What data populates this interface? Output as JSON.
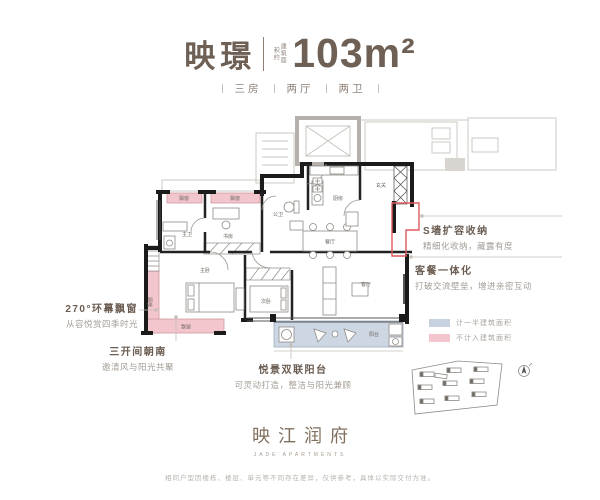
{
  "header": {
    "name": "映璟",
    "area_note": "建筑面积约",
    "area": "103m²",
    "specs": [
      "三房",
      "两厅",
      "两卫"
    ]
  },
  "annotations": {
    "s_wall": {
      "title": "S墙扩容收纳",
      "desc": "精细化收纳，藏露有度"
    },
    "dining_living": {
      "title": "客餐一体化",
      "desc": "打破交流壁垒，增进亲密互动"
    },
    "bay_window": {
      "title": "270°环幕飘窗",
      "desc": "从容悦赏四季时光"
    },
    "south_rooms": {
      "title": "三开间朝南",
      "desc": "邀清风与阳光共聚"
    },
    "balcony": {
      "title": "悦景双联阳台",
      "desc": "可灵动打造，整洁与阳光兼顾"
    }
  },
  "legend": {
    "half": {
      "label": "计一半建筑面积",
      "color": "#c7d1df"
    },
    "excluded": {
      "label": "不计入建筑面积",
      "color": "#f2c6cc"
    }
  },
  "plan": {
    "labels": {
      "bay": "飘窗",
      "master_bath": "主卫",
      "study": "书房",
      "guest_bath": "公卫",
      "kitchen": "厨房",
      "foyer": "玄关",
      "dining": "餐厅",
      "living": "客厅",
      "master": "主卧",
      "bedroom2": "次卧",
      "balcony": "阳台"
    }
  },
  "logo": {
    "name": "映江润府",
    "sub": "JADE APARTMENTS"
  },
  "disclaimer": "相同户型因楼栋、楼层、单元等不同存在差异，仅供参考，具体以实际交付为准。",
  "colors": {
    "brand": "#6e6055",
    "pink": "#f2c6cc",
    "blue": "#cdd7e4",
    "red": "#dd5a5f"
  }
}
